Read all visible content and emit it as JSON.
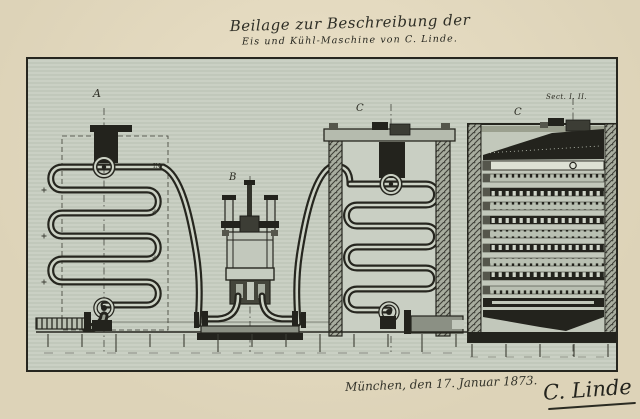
{
  "document": {
    "title_line1": "Beilage zur Beschreibung der",
    "title_line2": "Eis und Kühl-Maschine von C. Linde.",
    "date_line": "München, den 17. Januar 1873.",
    "signature": "C. Linde"
  },
  "labels": {
    "left_coil": "A",
    "pump": "B",
    "right_coil": "C",
    "section": "C",
    "section_caption": "Sect. I. II.",
    "inlet": "IN"
  },
  "colors": {
    "paper": "#ddd3b8",
    "paper_light": "#ebe1c8",
    "drawing_bg": "#c7cec1",
    "ink": "#26261f",
    "dark_fill": "#23231d",
    "tube_highlight": "#ccd2c5",
    "metal_gray": "#8b9084"
  }
}
